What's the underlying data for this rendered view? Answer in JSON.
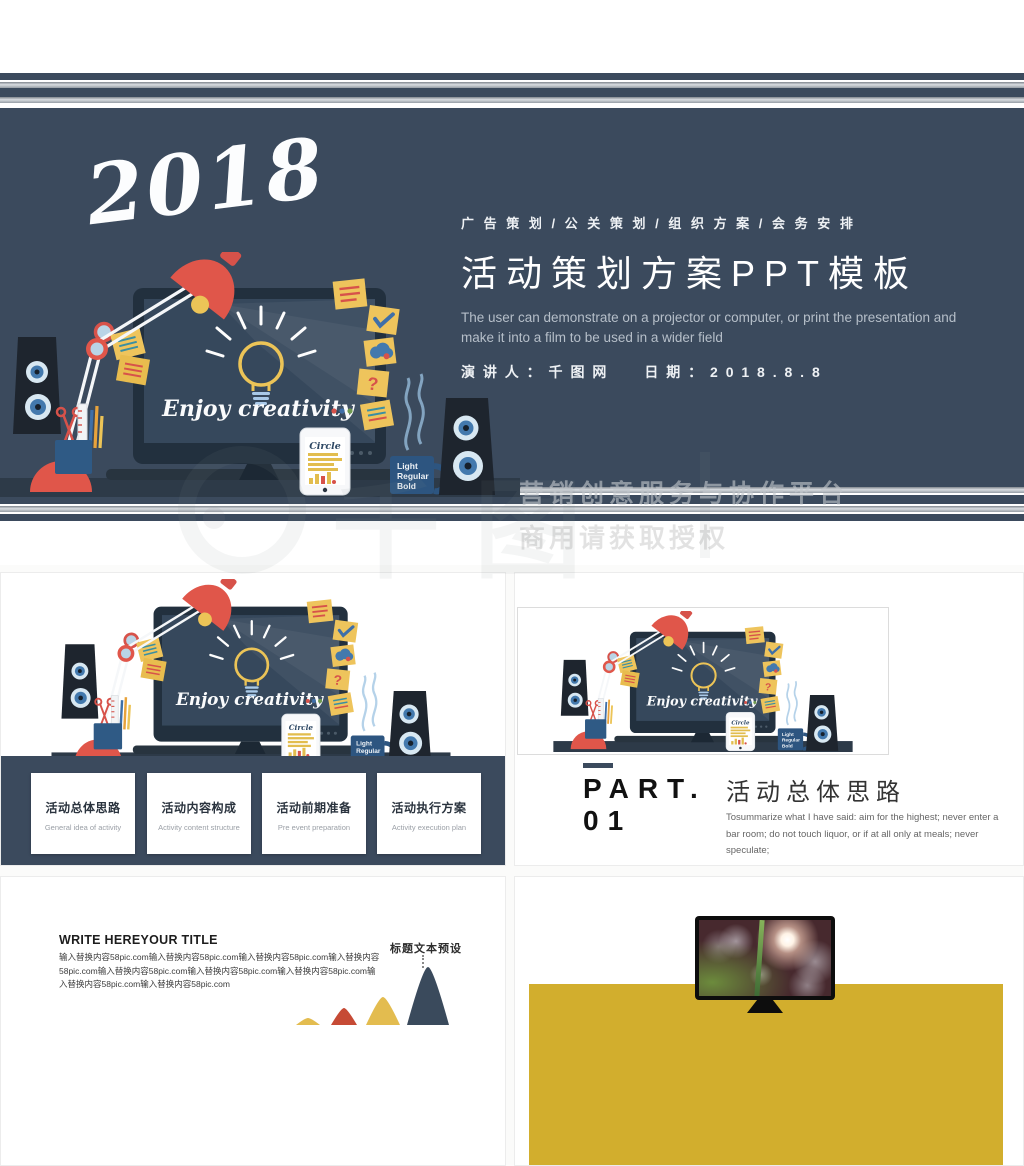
{
  "colors": {
    "navy": "#3b4a5d",
    "navy-dark": "#22303e",
    "screen": "#36485c",
    "desk": "#2d3a48",
    "red": "#e0564a",
    "yellow": "#ecc457",
    "gold": "#d2ae2d"
  },
  "slide1": {
    "year": "2018",
    "categories": "广 告 策 划  /  公 关 策 划  /  组 织 方 案  /  会 务 安 排",
    "title": "活动策划方案PPT模板",
    "subtitle_en": "The user can demonstrate on a projector or computer, or print the presentation and make it into a film to be used in a wider field",
    "presenter": "演 讲 人 ： 千 图 网",
    "date": "日 期 ： 2 0 1 8 . 8 . 8"
  },
  "illustration": {
    "enjoy_text": "Enjoy creativity",
    "phone_brand": "Circle",
    "question_mark": "?",
    "mug_lines": [
      "Light",
      "Regular",
      "Bold"
    ]
  },
  "slide2": {
    "cards": [
      {
        "zh": "活动总体思路",
        "en": "General idea of activity"
      },
      {
        "zh": "活动内容构成",
        "en": "Activity content structure"
      },
      {
        "zh": "活动前期准备",
        "en": "Pre event preparation"
      },
      {
        "zh": "活动执行方案",
        "en": "Activity execution plan"
      }
    ]
  },
  "slide3": {
    "part_label": "PART.",
    "part_number": "01",
    "heading": "活动总体思路",
    "body_en": "Tosummarize what I have said: aim for the highest; never enter a bar room; do not touch liquor, or if at all only at meals; never speculate;"
  },
  "slide4": {
    "title": "WRITE HEREYOUR TITLE",
    "body": "输入替换内容58pic.com输入替换内容58pic.com输入替换内容58pic.com输入替换内容58pic.com输入替换内容58pic.com输入替换内容58pic.com输入替换内容58pic.com输入替换内容58pic.com输入替换内容58pic.com",
    "callout": "标题文本预设"
  },
  "watermark": {
    "brand": "千图",
    "line1": "营销创意服务与协作平台",
    "line2": "商用请获取授权"
  }
}
